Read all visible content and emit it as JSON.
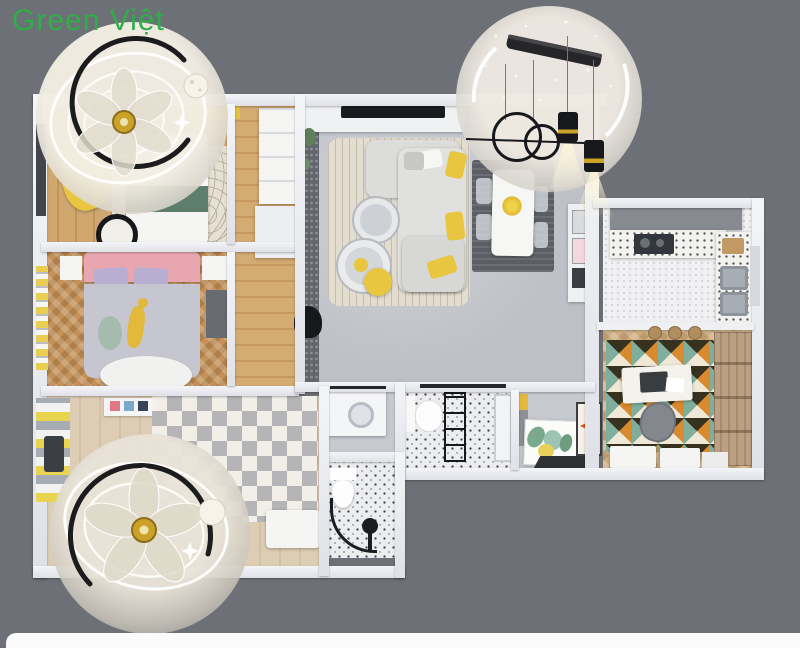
{
  "watermark": {
    "text": "Green Việt"
  },
  "palette": {
    "bg": "#6d7076",
    "wall": "#e9eaee",
    "green": "#2fae4a",
    "wood": "#cfa76f",
    "woodDark": "#c2945a",
    "herring": "#c49159",
    "herringLight": "#cfae7e",
    "livingFloor": "#bdc0c6",
    "kitchenFloor": "#f1f1f3",
    "tile": "#ecedef",
    "pebble": "#62656b",
    "rugBeige": "#e3ddd0",
    "diningRug": "#5b5e64",
    "yellow": "#e9c63f",
    "pink": "#e8a7b0",
    "lavender": "#b7aed2",
    "blanketGreen": "#5e7d6d",
    "gold": "#c9a227",
    "rugOrange": "#d98a2e",
    "rugTeal": "#7fae9d",
    "rugBlack": "#37311f",
    "rugCream": "#efe8d6",
    "zigA": "#b4b4b8",
    "zigB": "#f3f1eb"
  }
}
